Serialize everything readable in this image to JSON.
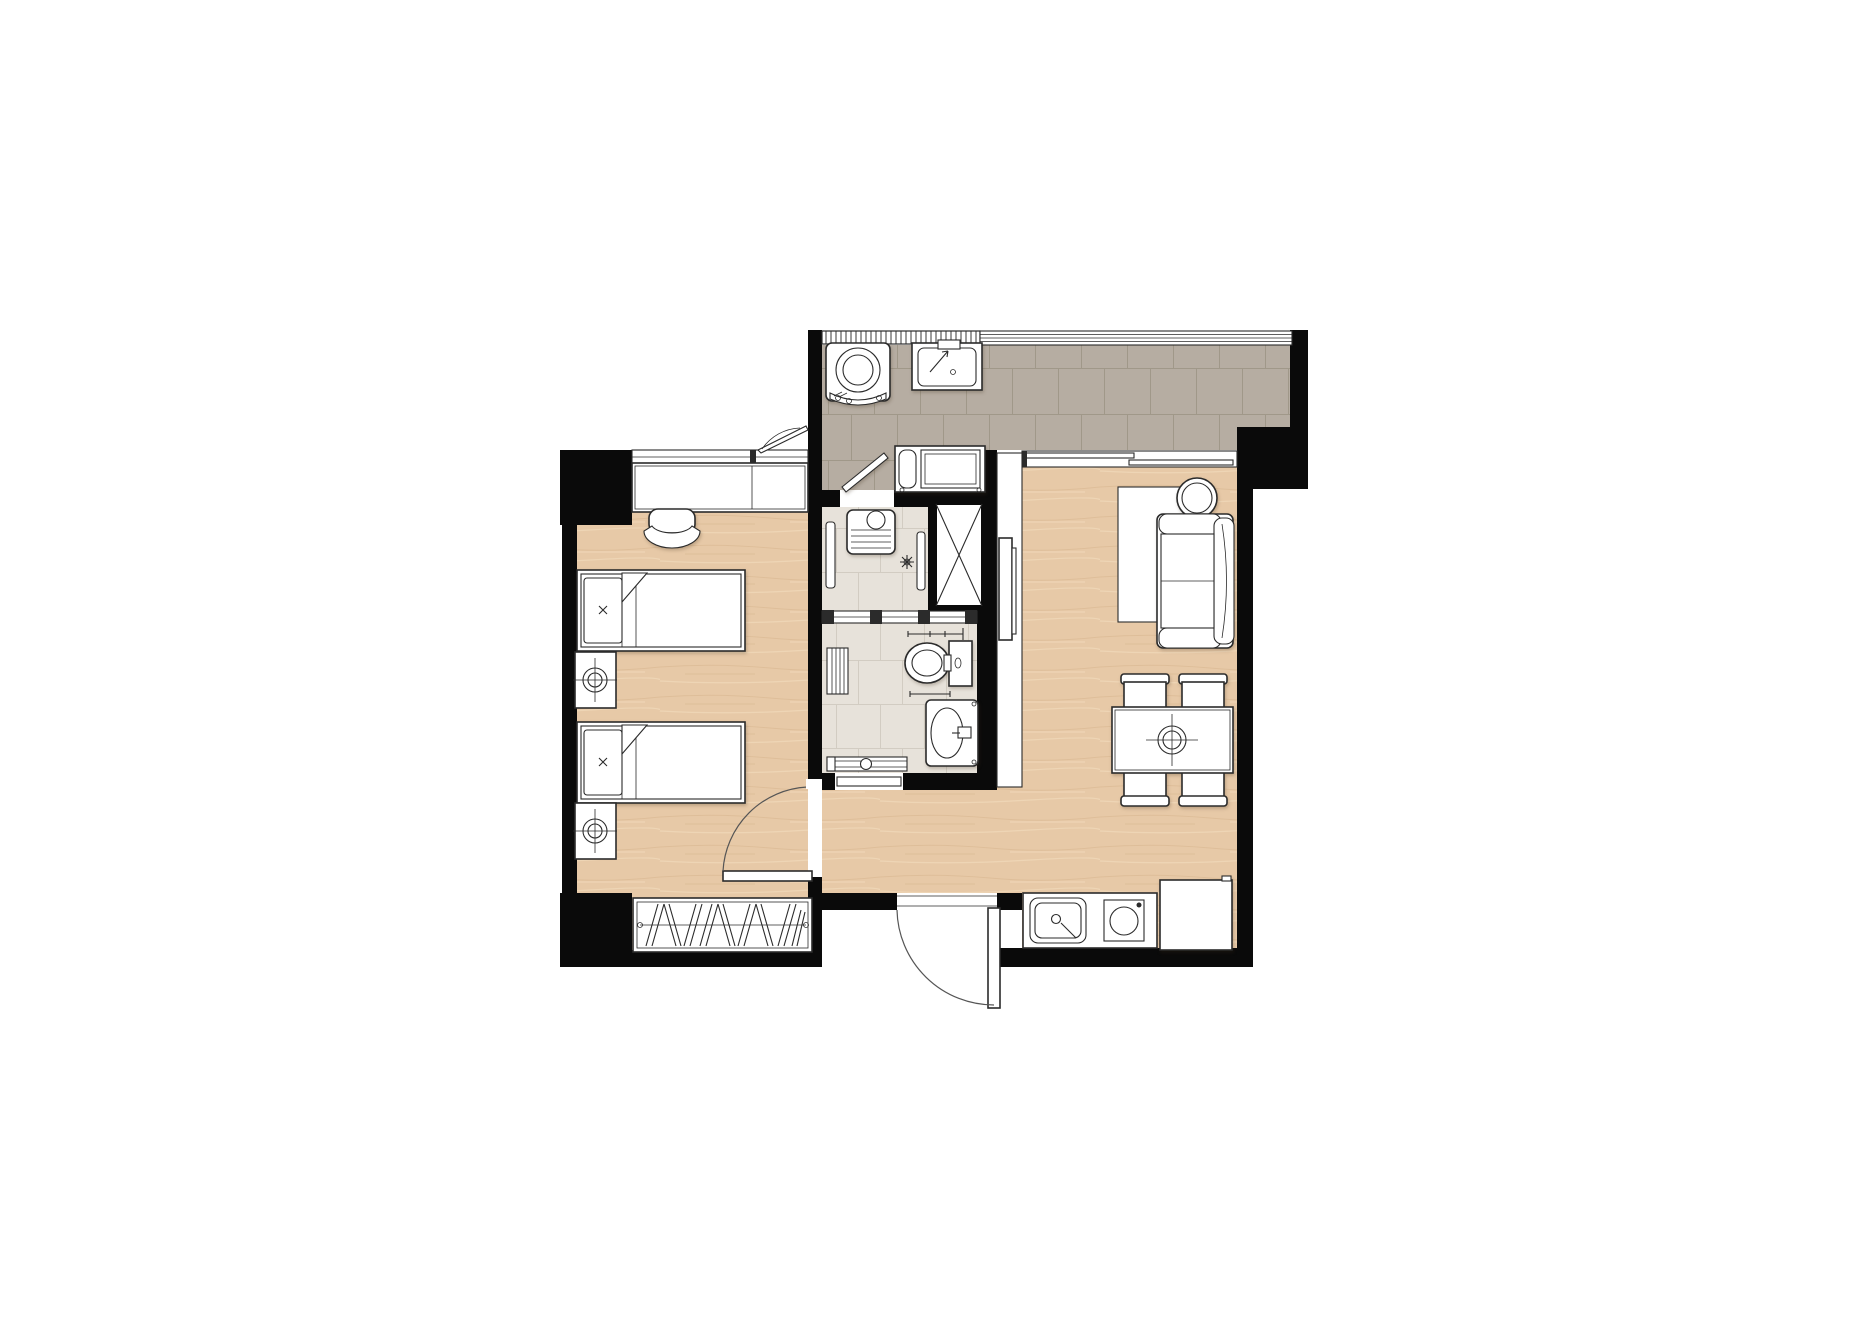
{
  "meta": {
    "kind": "apartment-floor-plan",
    "canvas_w": 1863,
    "canvas_h": 1317
  },
  "colors": {
    "wall": "#0a0a0a",
    "line": "#2b2b2b",
    "wood": "#e7c9a7",
    "woodStreakD": "#d7b48d",
    "woodStreakL": "#f3ddbe",
    "tileB": "#b6ada2",
    "groutB": "#a09889",
    "tileW": "#e7e2da",
    "groutW": "#d2ccc2",
    "paper": "#ffffff"
  },
  "rooms": {
    "bedroom": {
      "label": "Bedroom",
      "fixtures": [
        "desk",
        "desk-chair",
        "single-bed-1",
        "single-bed-2",
        "nightstand-lamp-1",
        "nightstand-lamp-2",
        "wardrobe-hangers",
        "awning-window",
        "swing-door"
      ]
    },
    "balcony": {
      "label": "Balcony / Laundry",
      "fixtures": [
        "washing-machine",
        "laundry-sink",
        "ac-condenser-unit",
        "railing",
        "glazing",
        "swing-door-to-shower"
      ]
    },
    "shower": {
      "label": "Shower Room",
      "fixtures": [
        "shelf-unit",
        "towel-rail",
        "shower-set",
        "service-shaft"
      ]
    },
    "wc": {
      "label": "WC",
      "fixtures": [
        "toilet",
        "wash-basin",
        "towel-bars",
        "slat-mat",
        "low-shelf",
        "door"
      ]
    },
    "living": {
      "label": "Living / Dining",
      "fixtures": [
        "wall-tv",
        "rug",
        "sofa",
        "round-side-table",
        "dining-table",
        "dining-chairs-x4",
        "table-centerpiece",
        "sliding-window"
      ]
    },
    "kitchen": {
      "label": "Kitchenette",
      "fixtures": [
        "counter",
        "kitchen-sink",
        "single-burner",
        "refrigerator"
      ]
    },
    "entry": {
      "label": "Entry",
      "fixtures": [
        "entrance-door"
      ]
    }
  }
}
